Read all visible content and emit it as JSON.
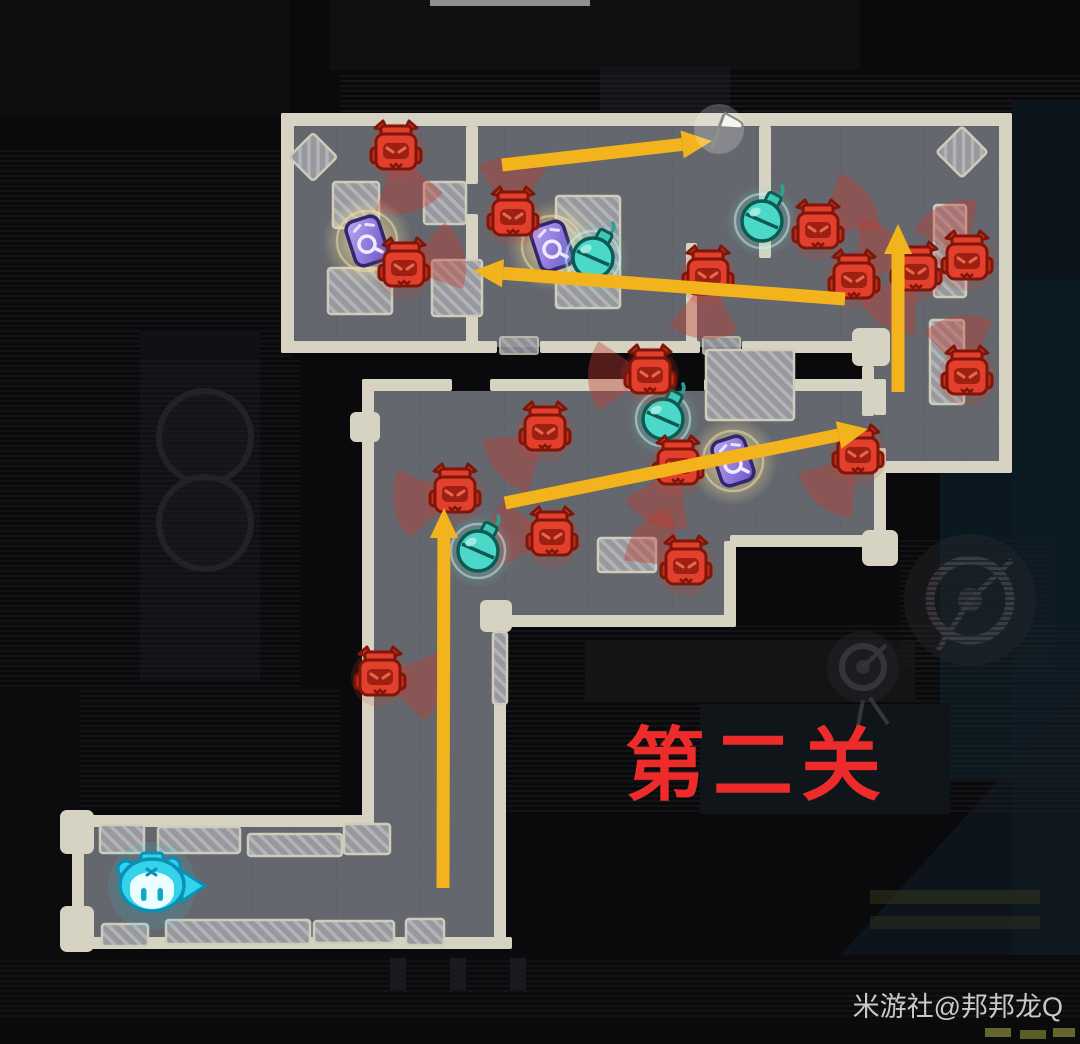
{
  "scene": {
    "type": "stealth-level-route-guide",
    "level_label": "第二关",
    "watermark": "米游社@邦邦龙Q"
  },
  "colors": {
    "route_arrow": "#f2b31d",
    "enemy": "#e2402c",
    "vision_cone": "#c63b2f",
    "bomb": "#49d6c6",
    "loot_card": "#8f78e0",
    "loot_glow": "#f5e3a0",
    "level_text": "#ee2b2b",
    "watermark_text": "#c9c9c9",
    "wall": "#d6d3c2",
    "floor": "#64676d",
    "player": "#35d2ee",
    "flag": "#f4f4f0"
  },
  "map": {
    "player_start": {
      "x": 152,
      "y": 886,
      "facing": "right"
    },
    "goal_flag": {
      "x": 719,
      "y": 129
    },
    "enemies": [
      {
        "x": 396,
        "y": 152,
        "cone": 75
      },
      {
        "x": 404,
        "y": 269,
        "cone": -15
      },
      {
        "x": 513,
        "y": 218,
        "cone": -90
      },
      {
        "x": 708,
        "y": 277,
        "cone": 95
      },
      {
        "x": 818,
        "y": 231,
        "cone": -35
      },
      {
        "x": 854,
        "y": 281,
        "cone": -50
      },
      {
        "x": 916,
        "y": 273,
        "cone": 125
      },
      {
        "x": 967,
        "y": 262,
        "cone": -115
      },
      {
        "x": 967,
        "y": 377,
        "cone": -100
      },
      {
        "x": 650,
        "y": 376,
        "cone": 180
      },
      {
        "x": 545,
        "y": 433,
        "cone": 140
      },
      {
        "x": 678,
        "y": 467,
        "cone": 115
      },
      {
        "x": 858,
        "y": 456,
        "cone": 130
      },
      {
        "x": 455,
        "y": 495,
        "cone": 170
      },
      {
        "x": 552,
        "y": 538,
        "cone": 185
      },
      {
        "x": 686,
        "y": 567,
        "cone": -140
      },
      {
        "x": 380,
        "y": 678,
        "cone": 10
      }
    ],
    "bombs": [
      {
        "x": 762,
        "y": 221
      },
      {
        "x": 593,
        "y": 258
      },
      {
        "x": 663,
        "y": 419
      },
      {
        "x": 478,
        "y": 551
      }
    ],
    "loot": [
      {
        "x": 367,
        "y": 241
      },
      {
        "x": 552,
        "y": 246
      },
      {
        "x": 733,
        "y": 461
      }
    ],
    "route_arrows": [
      {
        "x1": 502,
        "y1": 165,
        "x2": 712,
        "y2": 141
      },
      {
        "x1": 845,
        "y1": 299,
        "x2": 473,
        "y2": 271
      },
      {
        "x1": 898,
        "y1": 392,
        "x2": 898,
        "y2": 224
      },
      {
        "x1": 505,
        "y1": 503,
        "x2": 868,
        "y2": 429
      },
      {
        "x1": 443,
        "y1": 888,
        "x2": 444,
        "y2": 508
      }
    ]
  }
}
